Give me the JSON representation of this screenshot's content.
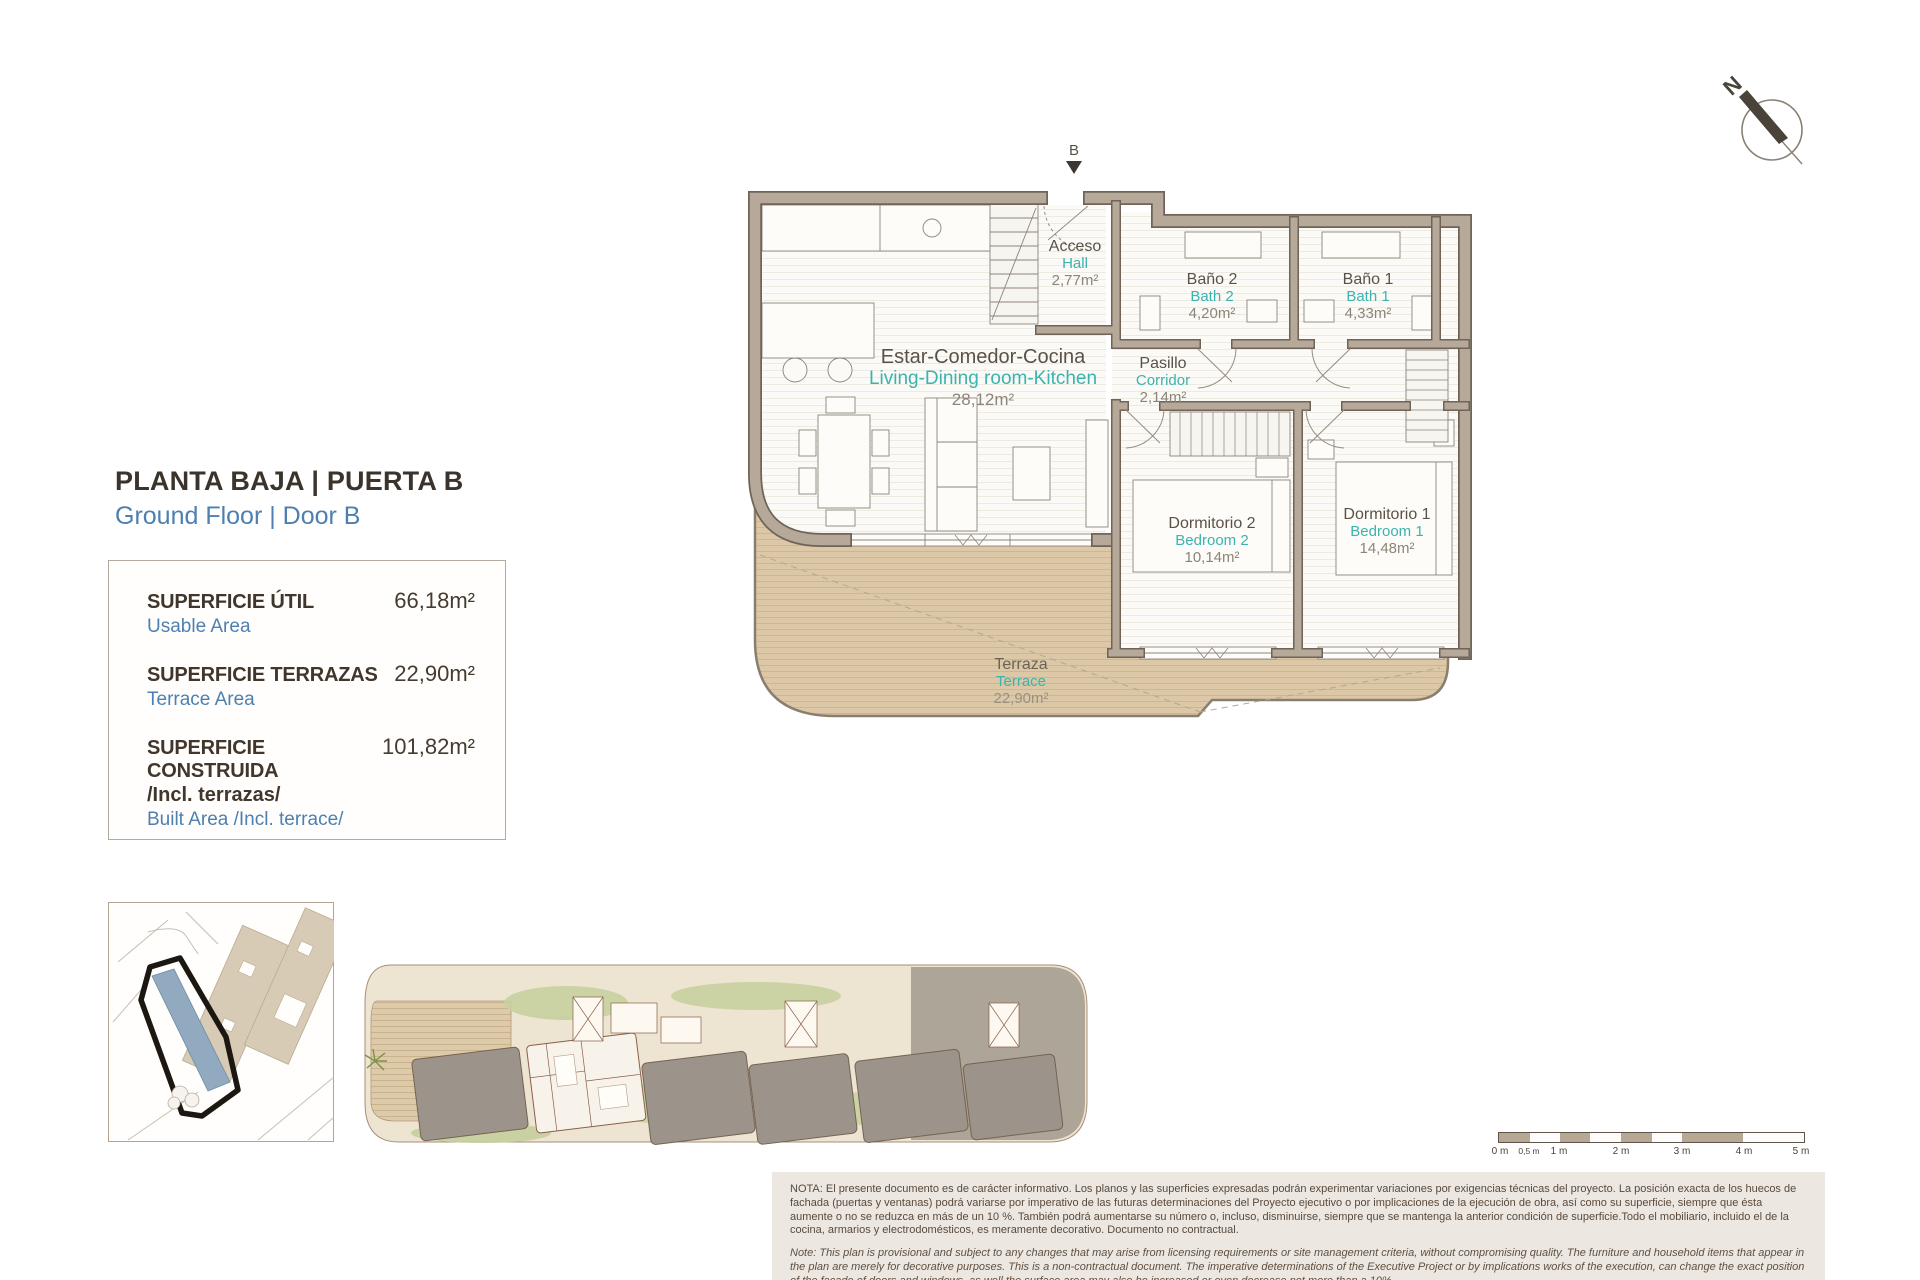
{
  "header": {
    "title_es": "PLANTA BAJA | PUERTA B",
    "title_en": "Ground Floor | Door B"
  },
  "areas": {
    "rows": [
      {
        "label_es": "SUPERFICIE ÚTIL",
        "label_en": "Usable Area",
        "value": "66,18m²"
      },
      {
        "label_es": "SUPERFICIE TERRAZAS",
        "label_en": "Terrace Area",
        "value": "22,90m²"
      },
      {
        "label_es": "SUPERFICIE CONSTRUIDA",
        "label_es2": "/Incl. terrazas/",
        "label_en": "Built Area /Incl. terrace/",
        "value": "101,82m²"
      }
    ]
  },
  "plan": {
    "entrance_label": "B",
    "north_label": "N",
    "rooms": [
      {
        "name_es": "Acceso",
        "name_en": "Hall",
        "area": "2,77m²"
      },
      {
        "name_es": "Estar-Comedor-Cocina",
        "name_en": "Living-Dining room-Kitchen",
        "area": "28,12m²"
      },
      {
        "name_es": "Baño 2",
        "name_en": "Bath 2",
        "area": "4,20m²"
      },
      {
        "name_es": "Baño 1",
        "name_en": "Bath 1",
        "area": "4,33m²"
      },
      {
        "name_es": "Pasillo",
        "name_en": "Corridor",
        "area": "2,14m²"
      },
      {
        "name_es": "Dormitorio 2",
        "name_en": "Bedroom 2",
        "area": "10,14m²"
      },
      {
        "name_es": "Dormitorio 1",
        "name_en": "Bedroom 1",
        "area": "14,48m²"
      },
      {
        "name_es": "Terraza",
        "name_en": "Terrace",
        "area": "22,90m²"
      }
    ]
  },
  "scalebar": {
    "labels": [
      "0 m",
      "0,5 m",
      "1 m",
      "2 m",
      "3 m",
      "4 m",
      "5 m"
    ]
  },
  "notes": {
    "es": "NOTA: El presente documento es de carácter informativo. Los planos y las superficies expresadas podrán experimentar variaciones por exigencias técnicas del proyecto. La posición exacta de los huecos de fachada (puertas y ventanas) podrá variarse por imperativo de las futuras determinaciones del Proyecto ejecutivo o por implicaciones de la ejecución de obra, así como su superficie, siempre que ésta aumente o no se reduzca en más de un 10 %. También podrá aumentarse su número o, incluso, disminuirse, siempre que se mantenga la anterior condición de superficie.Todo el mobiliario, incluido el de la cocina, armarios y electrodomésticos, es meramente decorativo. Documento no contractual.",
    "en": "Note: This plan is provisional and subject to any changes that may arise from licensing requirements or site management criteria, without compromising quality. The furniture and household items that appear in the plan are merely for decorative purposes. This is a non-contractual document. The imperative determinations of the Executive Project or by implications works of the execution, can change the exact position of the facade of doors and windows, as well the surface area may also be increased or even decrease not more than a 10%.",
    "version": "V.1_JUN-25"
  },
  "colors": {
    "accent_teal": "#3bb3ae",
    "accent_blue": "#4d80b0",
    "wall": "#b6a99a",
    "terrace": "#dcc7a6"
  }
}
